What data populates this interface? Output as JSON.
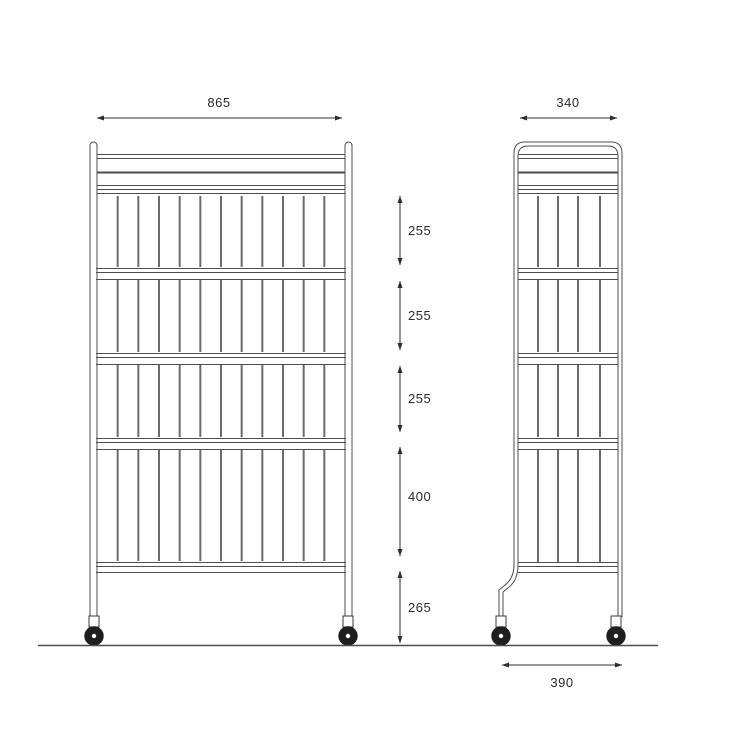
{
  "title": "Wire shelf trolley — dimensioned technical drawing, front and side views",
  "dimensions": {
    "front_width": "865",
    "side_depth": "340",
    "wheelbase": "390",
    "vertical": [
      "255",
      "255",
      "255",
      "400",
      "265"
    ]
  },
  "colors": {
    "line": "#4d4d4d",
    "bar": "#6b6b6b",
    "dimension": "#2e2e2e",
    "wheel": "#1f1f1f",
    "background": "#ffffff"
  }
}
